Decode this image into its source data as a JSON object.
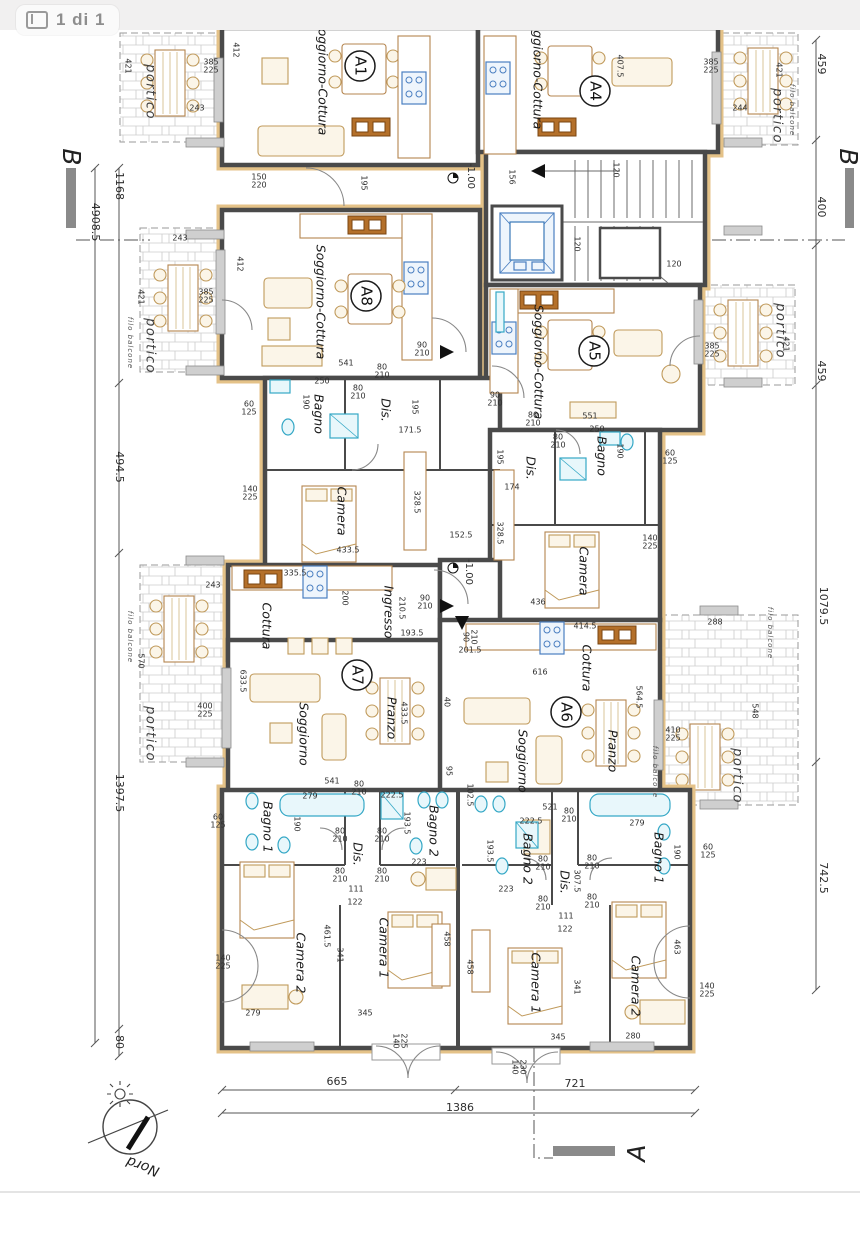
{
  "viewer": {
    "page_indicator": "1 di 1"
  },
  "colors": {
    "wall": "#4a4a4a",
    "wall_accent_tan": "#e4c288",
    "fixture_cyan": "#35a8c6",
    "stove_blue": "#4a7fc1",
    "sink_brown": "#b4702a",
    "topbar_bg": "#f1f0f0",
    "dim_text": "#2e2e2e"
  },
  "plan": {
    "apartments": [
      {
        "t": "A1",
        "x": 360,
        "y": 66
      },
      {
        "t": "A4",
        "x": 595,
        "y": 91
      },
      {
        "t": "A8",
        "x": 366,
        "y": 296
      },
      {
        "t": "A5",
        "x": 594,
        "y": 351
      },
      {
        "t": "A7",
        "x": 357,
        "y": 675
      },
      {
        "t": "A6",
        "x": 566,
        "y": 712
      }
    ],
    "section_markers": [
      {
        "t": "B",
        "x": 70,
        "y": 157,
        "r": 90
      },
      {
        "t": "B",
        "x": 847,
        "y": 157,
        "r": 90
      },
      {
        "t": "A",
        "x": 638,
        "y": 1153,
        "r": -90
      }
    ],
    "north": {
      "t": "Nord",
      "x": 143,
      "y": 1166,
      "r": 200
    },
    "rooms": [
      {
        "t": "Soggiorno-Cottura",
        "x": 322,
        "y": 78,
        "r": 90
      },
      {
        "t": "Soggiorno-Cottura",
        "x": 537,
        "y": 72,
        "r": 90
      },
      {
        "t": "Soggiorno-Cottura",
        "x": 320,
        "y": 302,
        "r": 90
      },
      {
        "t": "Soggiorno-Cottura",
        "x": 538,
        "y": 362,
        "r": 90
      },
      {
        "t": "Soggiorno",
        "x": 303,
        "y": 734,
        "r": 90
      },
      {
        "t": "Pranzo",
        "x": 391,
        "y": 718,
        "r": 90
      },
      {
        "t": "Soggiorno",
        "x": 522,
        "y": 761,
        "r": 90
      },
      {
        "t": "Pranzo",
        "x": 612,
        "y": 751,
        "r": 90
      },
      {
        "t": "Cottura",
        "x": 266,
        "y": 626,
        "r": 90
      },
      {
        "t": "Cottura",
        "x": 586,
        "y": 668,
        "r": 90
      },
      {
        "t": "Ingresso",
        "x": 388,
        "y": 612,
        "r": 90
      },
      {
        "t": "Camera",
        "x": 341,
        "y": 511,
        "r": 90
      },
      {
        "t": "Camera",
        "x": 583,
        "y": 571,
        "r": 90
      },
      {
        "t": "Bagno",
        "x": 318,
        "y": 414,
        "r": 90
      },
      {
        "t": "Dis.",
        "x": 385,
        "y": 410,
        "r": 90
      },
      {
        "t": "Bagno",
        "x": 601,
        "y": 456,
        "r": 90
      },
      {
        "t": "Dis.",
        "x": 530,
        "y": 468,
        "r": 90
      },
      {
        "t": "Bagno 1",
        "x": 267,
        "y": 827,
        "r": 90
      },
      {
        "t": "Bagno 2",
        "x": 433,
        "y": 831,
        "r": 90
      },
      {
        "t": "Dis.",
        "x": 357,
        "y": 854,
        "r": 90
      },
      {
        "t": "Camera 2",
        "x": 300,
        "y": 963,
        "r": 90
      },
      {
        "t": "Camera 1",
        "x": 383,
        "y": 948,
        "r": 90
      },
      {
        "t": "Bagno 2",
        "x": 527,
        "y": 859,
        "r": 90
      },
      {
        "t": "Bagno 1",
        "x": 658,
        "y": 858,
        "r": 90
      },
      {
        "t": "Dis.",
        "x": 564,
        "y": 882,
        "r": 90
      },
      {
        "t": "Camera 1",
        "x": 535,
        "y": 983,
        "r": 90
      },
      {
        "t": "Camera 2",
        "x": 635,
        "y": 986,
        "r": 90
      },
      {
        "t": "portico",
        "x": 150,
        "y": 92,
        "r": 90,
        "c": "portico"
      },
      {
        "t": "portico",
        "x": 777,
        "y": 116,
        "r": 90,
        "c": "portico"
      },
      {
        "t": "portico",
        "x": 150,
        "y": 346,
        "r": 90,
        "c": "portico"
      },
      {
        "t": "portico",
        "x": 780,
        "y": 331,
        "r": 90,
        "c": "portico"
      },
      {
        "t": "portico",
        "x": 150,
        "y": 734,
        "r": 90,
        "c": "portico"
      },
      {
        "t": "portico",
        "x": 737,
        "y": 776,
        "r": 90,
        "c": "portico"
      },
      {
        "t": "filo balcone",
        "x": 130,
        "y": 343,
        "r": 90,
        "c": "filo"
      },
      {
        "t": "filo balcone",
        "x": 130,
        "y": 637,
        "r": 90,
        "c": "filo"
      },
      {
        "t": "filo balcone",
        "x": 770,
        "y": 633,
        "r": 90,
        "c": "filo"
      },
      {
        "t": "filo balcone",
        "x": 792,
        "y": 110,
        "r": 90,
        "c": "filo"
      },
      {
        "t": "filo balcone",
        "x": 655,
        "y": 772,
        "r": 90,
        "c": "filo"
      }
    ],
    "dims": [
      {
        "t": "4908.5",
        "x": 95,
        "y": 222,
        "r": 90,
        "s": 11
      },
      {
        "t": "1168",
        "x": 119,
        "y": 186,
        "r": 90,
        "s": 11
      },
      {
        "t": "494.5",
        "x": 119,
        "y": 467,
        "r": 90,
        "s": 11
      },
      {
        "t": "1397.5",
        "x": 119,
        "y": 793,
        "r": 90,
        "s": 11
      },
      {
        "t": "80",
        "x": 119,
        "y": 1042,
        "r": 90,
        "s": 11
      },
      {
        "t": "459",
        "x": 821,
        "y": 64,
        "r": 90,
        "s": 11
      },
      {
        "t": "400",
        "x": 821,
        "y": 207,
        "r": 90,
        "s": 11
      },
      {
        "t": "459",
        "x": 821,
        "y": 371,
        "r": 90,
        "s": 11
      },
      {
        "t": "1079.5",
        "x": 823,
        "y": 606,
        "r": 90,
        "s": 11
      },
      {
        "t": "742.5",
        "x": 823,
        "y": 878,
        "r": 90,
        "s": 11
      },
      {
        "t": "665",
        "x": 337,
        "y": 1082,
        "s": 11
      },
      {
        "t": "721",
        "x": 575,
        "y": 1084,
        "s": 11
      },
      {
        "t": "1386",
        "x": 460,
        "y": 1108,
        "s": 11
      },
      {
        "t": "-1.00",
        "x": 471,
        "y": 176,
        "r": 90,
        "s": 10
      },
      {
        "t": "-1.00",
        "x": 469,
        "y": 572,
        "r": 90,
        "s": 10
      },
      {
        "t": "412",
        "x": 236,
        "y": 50,
        "r": 90
      },
      {
        "t": "385",
        "x": 211,
        "y": 62
      },
      {
        "t": "225",
        "x": 211,
        "y": 70
      },
      {
        "t": "243",
        "x": 197,
        "y": 108
      },
      {
        "t": "421",
        "x": 128,
        "y": 66,
        "r": 90
      },
      {
        "t": "150",
        "x": 259,
        "y": 177
      },
      {
        "t": "220",
        "x": 259,
        "y": 185
      },
      {
        "t": "195",
        "x": 364,
        "y": 183,
        "r": 90
      },
      {
        "t": "407.5",
        "x": 620,
        "y": 66,
        "r": 90
      },
      {
        "t": "385",
        "x": 711,
        "y": 62
      },
      {
        "t": "225",
        "x": 711,
        "y": 70
      },
      {
        "t": "244",
        "x": 740,
        "y": 108
      },
      {
        "t": "421",
        "x": 779,
        "y": 70,
        "r": 90
      },
      {
        "t": "156",
        "x": 512,
        "y": 177,
        "r": 90
      },
      {
        "t": "120",
        "x": 616,
        "y": 170,
        "r": 90
      },
      {
        "t": "120",
        "x": 577,
        "y": 244,
        "r": 90
      },
      {
        "t": "120",
        "x": 674,
        "y": 264
      },
      {
        "t": "412",
        "x": 240,
        "y": 264,
        "r": 90
      },
      {
        "t": "385",
        "x": 206,
        "y": 292
      },
      {
        "t": "225",
        "x": 206,
        "y": 300
      },
      {
        "t": "421",
        "x": 141,
        "y": 297,
        "r": 90
      },
      {
        "t": "243",
        "x": 180,
        "y": 238
      },
      {
        "t": "541",
        "x": 346,
        "y": 363
      },
      {
        "t": "90",
        "x": 422,
        "y": 345
      },
      {
        "t": "210",
        "x": 422,
        "y": 353
      },
      {
        "t": "80",
        "x": 358,
        "y": 388
      },
      {
        "t": "210",
        "x": 358,
        "y": 396
      },
      {
        "t": "80",
        "x": 382,
        "y": 367
      },
      {
        "t": "210",
        "x": 382,
        "y": 375
      },
      {
        "t": "250",
        "x": 322,
        "y": 381
      },
      {
        "t": "190",
        "x": 306,
        "y": 402,
        "r": 90
      },
      {
        "t": "60",
        "x": 249,
        "y": 404
      },
      {
        "t": "125",
        "x": 249,
        "y": 412
      },
      {
        "t": "195",
        "x": 415,
        "y": 407,
        "r": 90
      },
      {
        "t": "171.5",
        "x": 410,
        "y": 430
      },
      {
        "t": "140",
        "x": 250,
        "y": 489
      },
      {
        "t": "225",
        "x": 250,
        "y": 497
      },
      {
        "t": "328.5",
        "x": 417,
        "y": 502,
        "r": 90
      },
      {
        "t": "433.5",
        "x": 348,
        "y": 550
      },
      {
        "t": "152.5",
        "x": 461,
        "y": 535
      },
      {
        "t": "335.5",
        "x": 295,
        "y": 573
      },
      {
        "t": "200",
        "x": 345,
        "y": 598,
        "r": 90
      },
      {
        "t": "90",
        "x": 425,
        "y": 598
      },
      {
        "t": "210",
        "x": 425,
        "y": 606
      },
      {
        "t": "210.5",
        "x": 402,
        "y": 608,
        "r": 90
      },
      {
        "t": "193.5",
        "x": 412,
        "y": 633
      },
      {
        "t": "201.5",
        "x": 470,
        "y": 650
      },
      {
        "t": "90",
        "x": 466,
        "y": 637,
        "r": 90
      },
      {
        "t": "210",
        "x": 474,
        "y": 637,
        "r": 90
      },
      {
        "t": "551",
        "x": 590,
        "y": 416
      },
      {
        "t": "90",
        "x": 495,
        "y": 395
      },
      {
        "t": "210",
        "x": 495,
        "y": 403
      },
      {
        "t": "80",
        "x": 533,
        "y": 415
      },
      {
        "t": "210",
        "x": 533,
        "y": 423
      },
      {
        "t": "80",
        "x": 558,
        "y": 437
      },
      {
        "t": "210",
        "x": 558,
        "y": 445
      },
      {
        "t": "250",
        "x": 597,
        "y": 429
      },
      {
        "t": "190",
        "x": 620,
        "y": 451,
        "r": 90
      },
      {
        "t": "60",
        "x": 670,
        "y": 453
      },
      {
        "t": "125",
        "x": 670,
        "y": 461
      },
      {
        "t": "195",
        "x": 500,
        "y": 457,
        "r": 90
      },
      {
        "t": "174",
        "x": 512,
        "y": 487
      },
      {
        "t": "328.5",
        "x": 500,
        "y": 533,
        "r": 90
      },
      {
        "t": "140",
        "x": 650,
        "y": 538
      },
      {
        "t": "225",
        "x": 650,
        "y": 546
      },
      {
        "t": "436",
        "x": 538,
        "y": 602
      },
      {
        "t": "385",
        "x": 712,
        "y": 346
      },
      {
        "t": "225",
        "x": 712,
        "y": 354
      },
      {
        "t": "421",
        "x": 786,
        "y": 344,
        "r": 90
      },
      {
        "t": "570",
        "x": 141,
        "y": 661,
        "r": 90
      },
      {
        "t": "243",
        "x": 213,
        "y": 585
      },
      {
        "t": "400",
        "x": 205,
        "y": 706
      },
      {
        "t": "225",
        "x": 205,
        "y": 714
      },
      {
        "t": "633.5",
        "x": 243,
        "y": 681,
        "r": 90
      },
      {
        "t": "288",
        "x": 715,
        "y": 622
      },
      {
        "t": "548",
        "x": 755,
        "y": 711,
        "r": 90
      },
      {
        "t": "410",
        "x": 673,
        "y": 730
      },
      {
        "t": "225",
        "x": 673,
        "y": 738
      },
      {
        "t": "616",
        "x": 540,
        "y": 672
      },
      {
        "t": "414.5",
        "x": 585,
        "y": 626
      },
      {
        "t": "564.5",
        "x": 639,
        "y": 697,
        "r": 90
      },
      {
        "t": "433.5",
        "x": 404,
        "y": 713,
        "r": 90
      },
      {
        "t": "40",
        "x": 447,
        "y": 702,
        "r": 90
      },
      {
        "t": "95",
        "x": 449,
        "y": 771,
        "r": 90
      },
      {
        "t": "102.5",
        "x": 470,
        "y": 795,
        "r": 90
      },
      {
        "t": "541",
        "x": 332,
        "y": 781
      },
      {
        "t": "80",
        "x": 359,
        "y": 784
      },
      {
        "t": "210",
        "x": 359,
        "y": 792
      },
      {
        "t": "521",
        "x": 550,
        "y": 807
      },
      {
        "t": "80",
        "x": 569,
        "y": 811
      },
      {
        "t": "210",
        "x": 569,
        "y": 819
      },
      {
        "t": "279",
        "x": 310,
        "y": 796
      },
      {
        "t": "190",
        "x": 297,
        "y": 824,
        "r": 90
      },
      {
        "t": "222.5",
        "x": 392,
        "y": 795
      },
      {
        "t": "193.5",
        "x": 407,
        "y": 823,
        "r": 90
      },
      {
        "t": "80",
        "x": 340,
        "y": 831
      },
      {
        "t": "210",
        "x": 340,
        "y": 839
      },
      {
        "t": "80",
        "x": 382,
        "y": 831
      },
      {
        "t": "210",
        "x": 382,
        "y": 839
      },
      {
        "t": "80",
        "x": 340,
        "y": 871
      },
      {
        "t": "210",
        "x": 340,
        "y": 879
      },
      {
        "t": "80",
        "x": 382,
        "y": 871
      },
      {
        "t": "210",
        "x": 382,
        "y": 879
      },
      {
        "t": "223",
        "x": 419,
        "y": 862
      },
      {
        "t": "111",
        "x": 356,
        "y": 889
      },
      {
        "t": "122",
        "x": 355,
        "y": 902
      },
      {
        "t": "461.5",
        "x": 327,
        "y": 936,
        "r": 90
      },
      {
        "t": "341",
        "x": 340,
        "y": 955,
        "r": 90
      },
      {
        "t": "458",
        "x": 447,
        "y": 939,
        "r": 90
      },
      {
        "t": "60",
        "x": 218,
        "y": 817
      },
      {
        "t": "125",
        "x": 218,
        "y": 825
      },
      {
        "t": "140",
        "x": 223,
        "y": 958
      },
      {
        "t": "225",
        "x": 223,
        "y": 966
      },
      {
        "t": "279",
        "x": 253,
        "y": 1013
      },
      {
        "t": "345",
        "x": 365,
        "y": 1013
      },
      {
        "t": "140",
        "x": 396,
        "y": 1041,
        "r": 90
      },
      {
        "t": "225",
        "x": 404,
        "y": 1041,
        "r": 90
      },
      {
        "t": "222.5",
        "x": 531,
        "y": 821
      },
      {
        "t": "193.5",
        "x": 490,
        "y": 851,
        "r": 90
      },
      {
        "t": "279",
        "x": 637,
        "y": 823
      },
      {
        "t": "190",
        "x": 677,
        "y": 852,
        "r": 90
      },
      {
        "t": "60",
        "x": 708,
        "y": 847
      },
      {
        "t": "125",
        "x": 708,
        "y": 855
      },
      {
        "t": "307.5",
        "x": 577,
        "y": 881,
        "r": 90
      },
      {
        "t": "223",
        "x": 506,
        "y": 889
      },
      {
        "t": "80",
        "x": 543,
        "y": 859
      },
      {
        "t": "210",
        "x": 543,
        "y": 867
      },
      {
        "t": "80",
        "x": 592,
        "y": 858
      },
      {
        "t": "210",
        "x": 592,
        "y": 866
      },
      {
        "t": "80",
        "x": 543,
        "y": 899
      },
      {
        "t": "210",
        "x": 543,
        "y": 907
      },
      {
        "t": "80",
        "x": 592,
        "y": 897
      },
      {
        "t": "210",
        "x": 592,
        "y": 905
      },
      {
        "t": "111",
        "x": 566,
        "y": 916
      },
      {
        "t": "122",
        "x": 565,
        "y": 929
      },
      {
        "t": "341",
        "x": 577,
        "y": 987,
        "r": 90
      },
      {
        "t": "458",
        "x": 470,
        "y": 967,
        "r": 90
      },
      {
        "t": "463",
        "x": 677,
        "y": 947,
        "r": 90
      },
      {
        "t": "140",
        "x": 707,
        "y": 986
      },
      {
        "t": "225",
        "x": 707,
        "y": 994
      },
      {
        "t": "280",
        "x": 633,
        "y": 1036
      },
      {
        "t": "345",
        "x": 558,
        "y": 1037
      },
      {
        "t": "140",
        "x": 515,
        "y": 1067,
        "r": 90
      },
      {
        "t": "230",
        "x": 523,
        "y": 1067,
        "r": 90
      }
    ]
  }
}
